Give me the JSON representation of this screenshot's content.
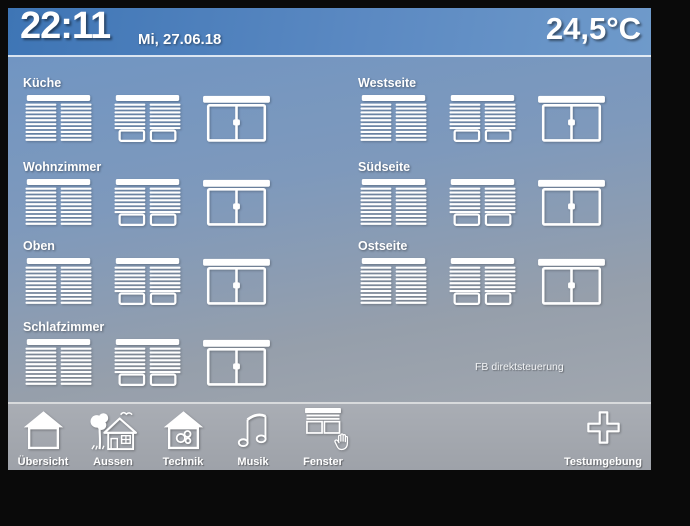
{
  "header": {
    "time": "22:11",
    "date": "Mi, 27.06.18",
    "temperature": "24,5°C"
  },
  "rooms": {
    "left": [
      {
        "label": "Küche",
        "blinds": [
          "closed",
          "partial",
          "open"
        ]
      },
      {
        "label": "Wohnzimmer",
        "blinds": [
          "closed",
          "partial",
          "open"
        ]
      },
      {
        "label": "Oben",
        "blinds": [
          "closed",
          "partial",
          "open"
        ]
      },
      {
        "label": "Schlafzimmer",
        "blinds": [
          "closed",
          "partial",
          "open"
        ]
      }
    ],
    "right": [
      {
        "label": "Westseite",
        "blinds": [
          "closed",
          "partial",
          "open"
        ]
      },
      {
        "label": "Südseite",
        "blinds": [
          "closed",
          "partial",
          "open"
        ]
      },
      {
        "label": "Ostseite",
        "blinds": [
          "closed",
          "partial",
          "open"
        ]
      }
    ]
  },
  "remote_label": "FB direktsteuerung",
  "toolbar": {
    "items": [
      {
        "label": "Übersicht",
        "icon": "house",
        "active": false
      },
      {
        "label": "Aussen",
        "icon": "garden-house",
        "active": false
      },
      {
        "label": "Technik",
        "icon": "house-gears",
        "active": false
      },
      {
        "label": "Musik",
        "icon": "music-notes",
        "active": false
      },
      {
        "label": "Fenster",
        "icon": "window-blind",
        "active": true
      }
    ],
    "right_item": {
      "label": "Testumgebung",
      "icon": "plus"
    }
  },
  "colors": {
    "header_blue": "#4a80c0",
    "background_bottom_gray": "#a7abb1",
    "icon_white": "#ffffff",
    "bezel_black": "#0a0a0a"
  }
}
